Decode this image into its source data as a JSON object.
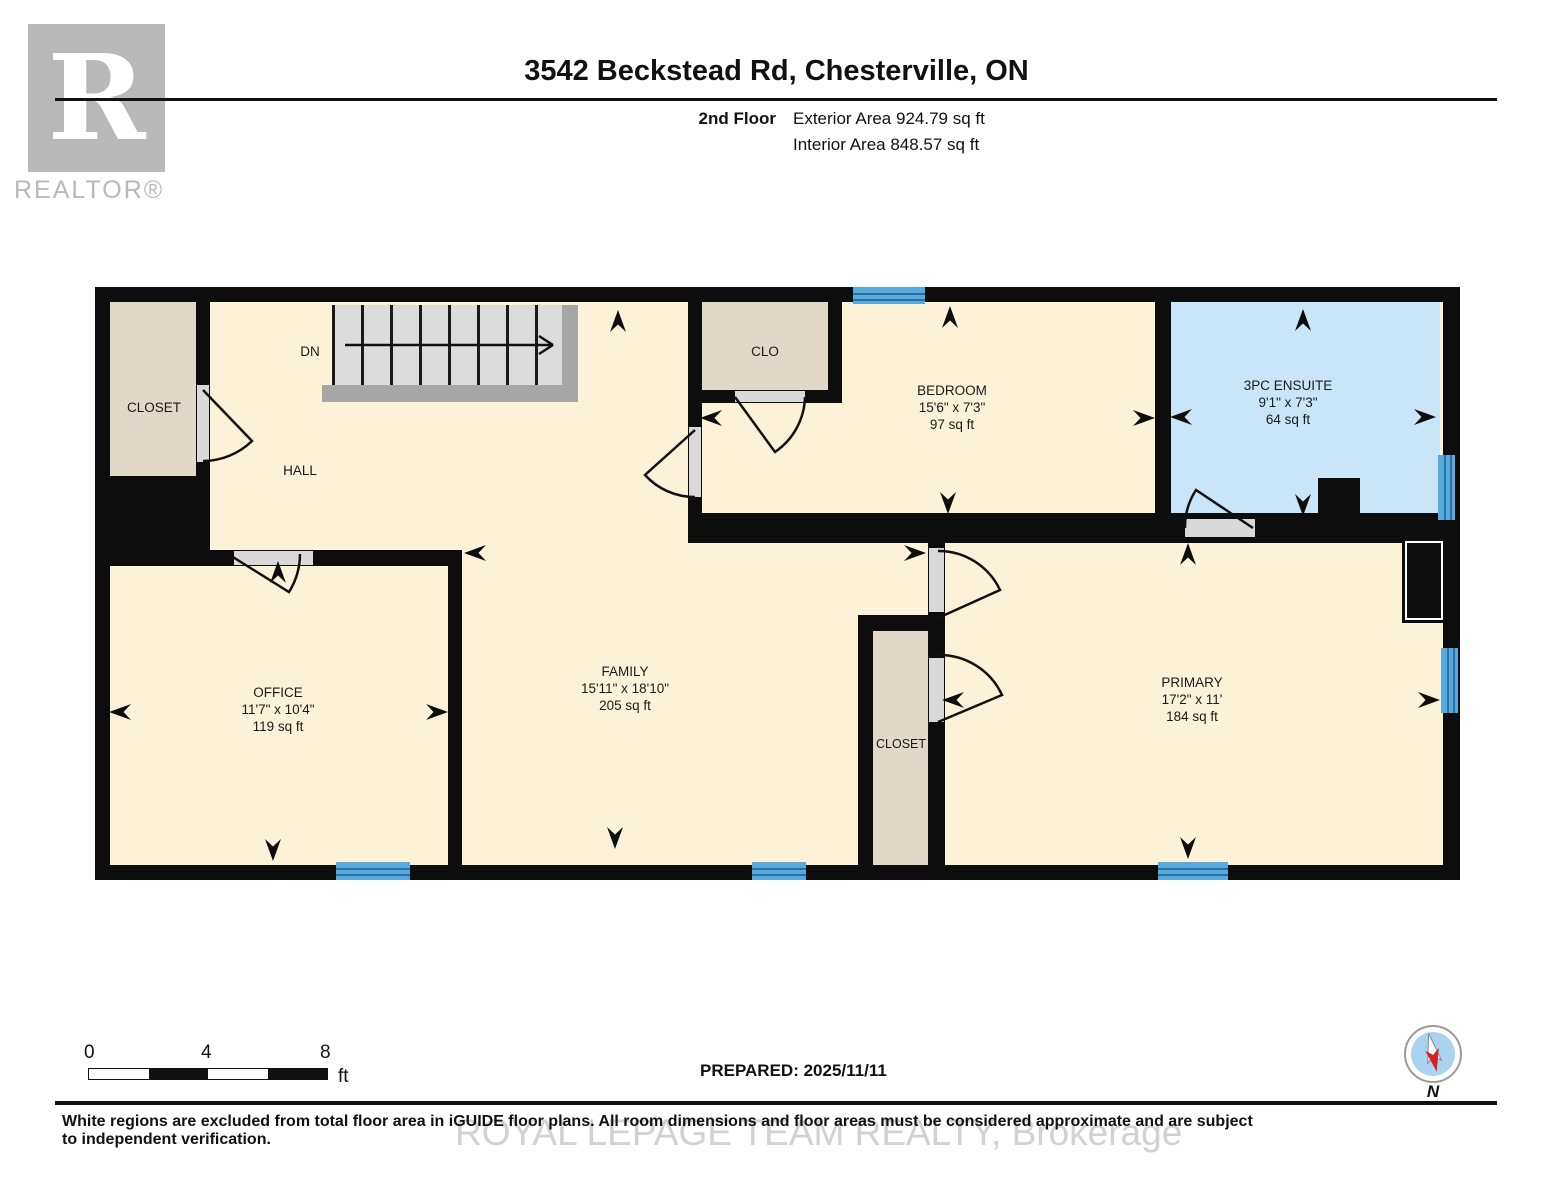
{
  "header": {
    "logo_letter": "R",
    "logo_brand": "REALTOR®",
    "title": "3542 Beckstead Rd, Chesterville, ON",
    "floor_label": "2nd Floor",
    "exterior_area": "Exterior Area 924.79 sq ft",
    "interior_area": "Interior Area 848.57 sq ft"
  },
  "plan": {
    "colors": {
      "wall": "#0d0d0d",
      "floor": "#fbf2d8",
      "closet": "#e2d8c9",
      "ensuite": "#c9e5f8",
      "window_blue": "#58a9dc",
      "window_line": "#2b6ea5",
      "stair_tread": "#dcdcdc",
      "stair_rail": "#a6a6a6",
      "threshold": "#d9d9d9",
      "logo_gray": "#b9b9b9",
      "watermark_gray": "#d2d2d2"
    },
    "rooms": {
      "closet_tl": {
        "name": "CLOSET"
      },
      "hall": {
        "name": "HALL"
      },
      "stairs": {
        "label": "DN"
      },
      "clo": {
        "name": "CLO"
      },
      "bedroom": {
        "name": "BEDROOM",
        "dims": "15'6\" x 7'3\"",
        "area": "97 sq ft"
      },
      "ensuite": {
        "name": "3PC ENSUITE",
        "dims": "9'1\" x 7'3\"",
        "area": "64 sq ft"
      },
      "office": {
        "name": "OFFICE",
        "dims": "11'7\" x 10'4\"",
        "area": "119 sq ft"
      },
      "family": {
        "name": "FAMILY",
        "dims": "15'11\" x 18'10\"",
        "area": "205 sq ft"
      },
      "closet_mid": {
        "name": "CLOSET"
      },
      "primary": {
        "name": "PRIMARY",
        "dims": "17'2\" x 11'",
        "area": "184 sq ft"
      }
    }
  },
  "footer": {
    "scale_ticks": {
      "t0": "0",
      "t4": "4",
      "t8": "8"
    },
    "scale_unit": "ft",
    "prepared": "PREPARED: 2025/11/11",
    "compass_label": "N",
    "disclaimer": "White regions are excluded from total floor area in iGUIDE floor plans. All room dimensions and floor areas must be considered approximate and are subject to independent verification.",
    "watermark": "ROYAL LEPAGE TEAM REALTY, Brokerage"
  }
}
